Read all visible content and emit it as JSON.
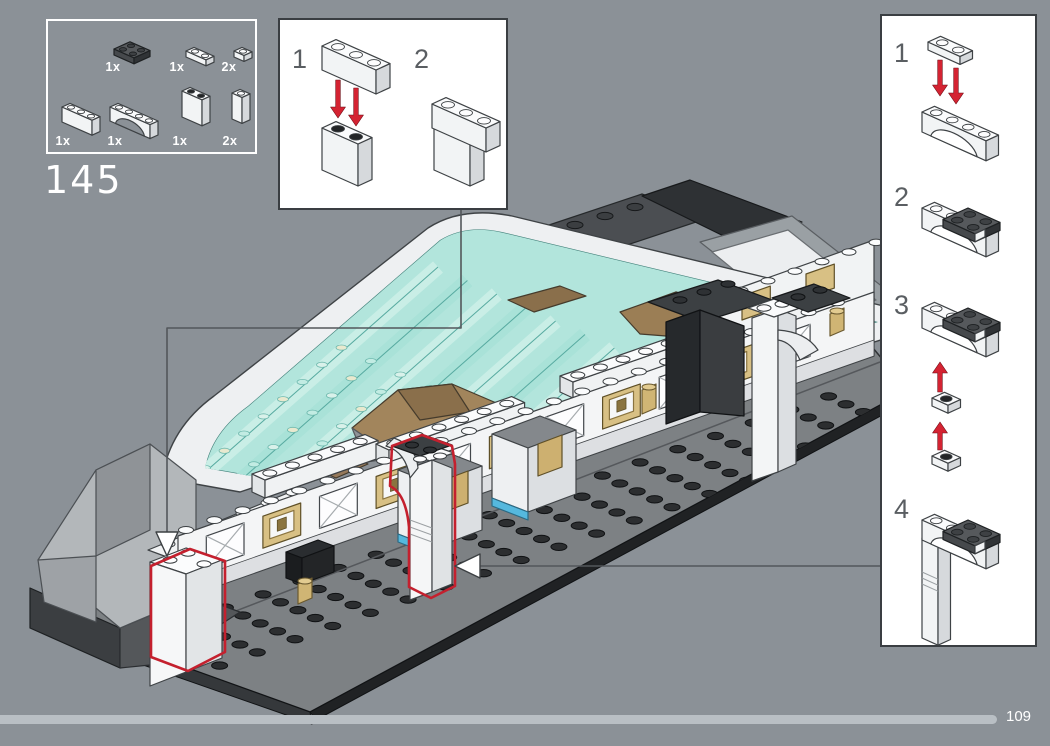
{
  "page": {
    "number": "109",
    "background": "#8b9197",
    "progress_fraction": 0.95
  },
  "step": {
    "number": "145"
  },
  "parts_box": {
    "rows": [
      {
        "parts": [
          {
            "name": "dark-gray-2x2-plate",
            "qty": "1x"
          },
          {
            "name": "white-1x2-plate",
            "qty": "1x"
          },
          {
            "name": "white-1x1-plate",
            "qty": "2x"
          }
        ]
      },
      {
        "parts": [
          {
            "name": "white-1x3-brick",
            "qty": "1x"
          },
          {
            "name": "white-1x4-arch-brick",
            "qty": "1x"
          },
          {
            "name": "white-1x2x2-panel",
            "qty": "1x"
          },
          {
            "name": "white-1x1x2-brick",
            "qty": "2x"
          }
        ]
      }
    ]
  },
  "assembly_inset": {
    "steps": [
      {
        "label": "1"
      },
      {
        "label": "2"
      }
    ]
  },
  "sidebar_inset": {
    "steps": [
      {
        "label": "1"
      },
      {
        "label": "2"
      },
      {
        "label": "3"
      },
      {
        "label": "4"
      }
    ]
  },
  "colors": {
    "red_outline": "#c4202e",
    "arrow_red": "#d42332",
    "teal": "#b2e5dc",
    "teal_line": "#57aaa0",
    "tan": "#cdb070",
    "progress": "#b9bfc4",
    "leader_line": "#53575b"
  }
}
